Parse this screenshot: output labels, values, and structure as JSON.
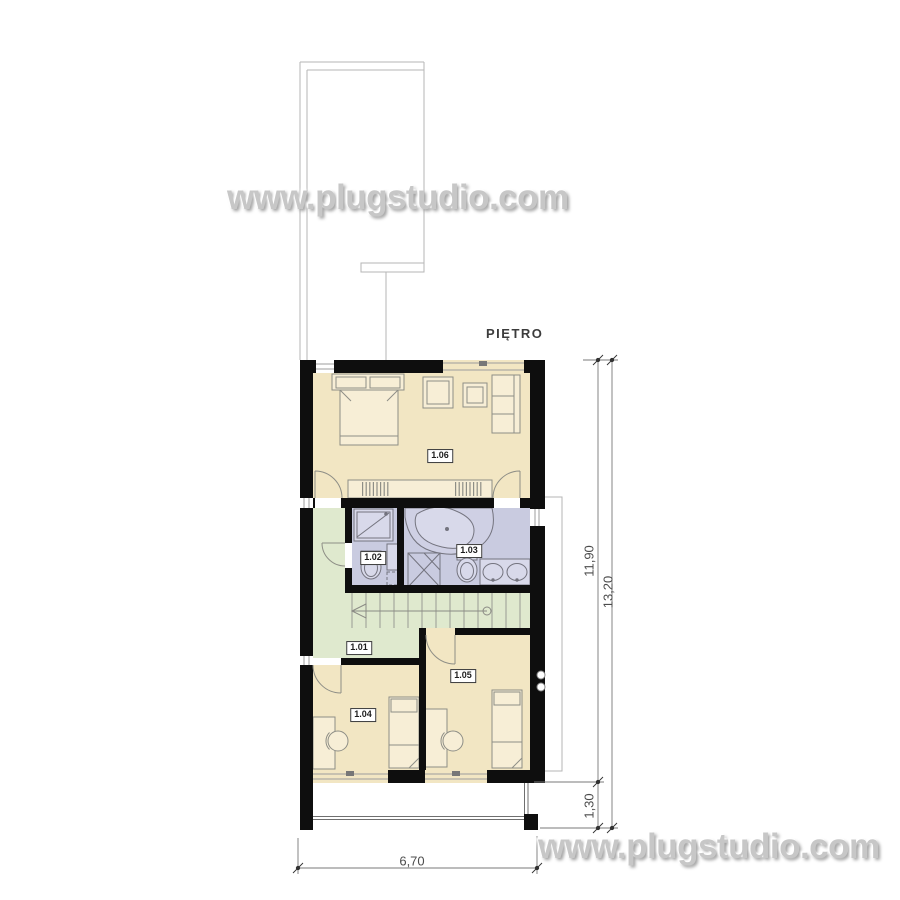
{
  "title": "PIĘTRO",
  "watermark": {
    "top": "www.plugstudio.com",
    "bottom": "www.plugstudio.com"
  },
  "rooms": [
    {
      "label": "1.01"
    },
    {
      "label": "1.02"
    },
    {
      "label": "1.03"
    },
    {
      "label": "1.04"
    },
    {
      "label": "1.05"
    },
    {
      "label": "1.06"
    }
  ],
  "dimensions": {
    "height_inner": "11,90",
    "height_total": "13,20",
    "balcony_depth": "1,30",
    "width": "6,70"
  },
  "colors": {
    "bedroom_fill": "#f2e6c3",
    "hall_fill": "#dfe9ce",
    "bath_fill": "#c9cbe0",
    "wall": "#0e0e0e"
  }
}
